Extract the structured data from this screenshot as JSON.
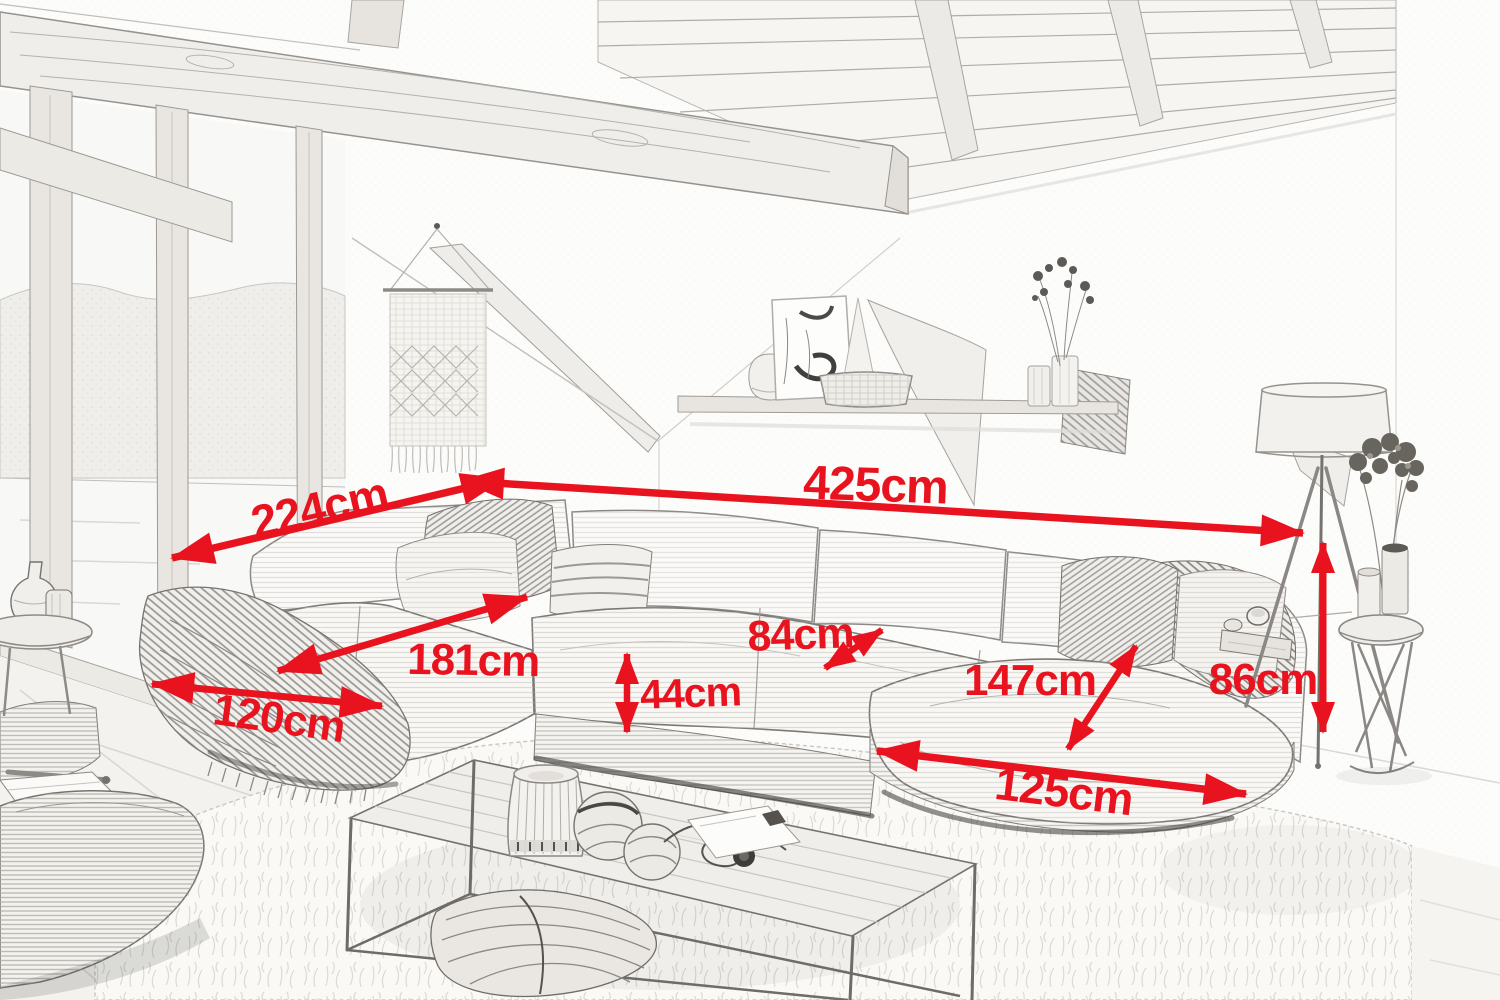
{
  "image_type": "furniture-dimension-sketch",
  "scene": {
    "style": "pencil-sketch living room",
    "objects": [
      "ceiling-beams",
      "window-wall",
      "macrame-wall-hanging",
      "wall-shelf",
      "u-shaped-corduroy-sectional-sofa",
      "blanket",
      "pillows",
      "coffee-table",
      "shag-rug",
      "pouf",
      "floor-lamp",
      "side-table",
      "flower-vase"
    ]
  },
  "colors": {
    "annotation_red": "#e8131e",
    "paper": "#fcfcfa",
    "sketch_gray": "#8a8784"
  },
  "annotations": {
    "unit": "cm",
    "items": [
      {
        "name": "sofa-total-width",
        "label": "425cm",
        "value": 425
      },
      {
        "name": "left-section-depth",
        "label": "224cm",
        "value": 224
      },
      {
        "name": "left-chaise-length",
        "label": "181cm",
        "value": 181
      },
      {
        "name": "left-chaise-width",
        "label": "120cm",
        "value": 120
      },
      {
        "name": "seat-height",
        "label": "44cm",
        "value": 44
      },
      {
        "name": "seat-depth",
        "label": "84cm",
        "value": 84
      },
      {
        "name": "right-section-depth",
        "label": "147cm",
        "value": 147
      },
      {
        "name": "back-height",
        "label": "86cm",
        "value": 86
      },
      {
        "name": "right-chaise-width",
        "label": "125cm",
        "value": 125
      }
    ]
  }
}
